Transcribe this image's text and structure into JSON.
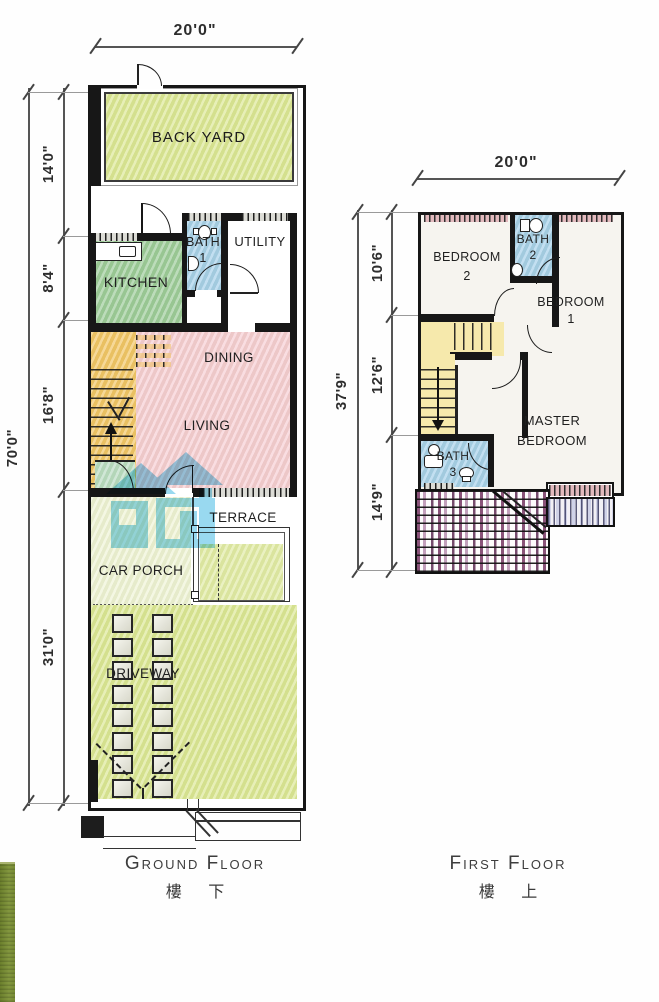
{
  "ground_floor": {
    "title": "Ground Floor",
    "title_cn": "樓 下",
    "dims": {
      "width": "20'0\"",
      "total_depth": "70'0\"",
      "segments": [
        "14'0\"",
        "8'4\"",
        "16'8\"",
        "31'0\""
      ]
    },
    "rooms": {
      "back_yard": "BACK YARD",
      "kitchen": "KITCHEN",
      "bath1": [
        "BATH",
        "1"
      ],
      "utility": "UTILITY",
      "dining": "DINING",
      "living": "LIVING",
      "terrace": "TERRACE",
      "car_porch": "CAR PORCH",
      "driveway": "DRIVEWAY"
    }
  },
  "first_floor": {
    "title": "First Floor",
    "title_cn": "樓 上",
    "dims": {
      "width": "20'0\"",
      "total_depth": "37'9\"",
      "segments": [
        "10'6\"",
        "12'6\"",
        "14'9\""
      ]
    },
    "rooms": {
      "bedroom2": [
        "BEDROOM",
        "2"
      ],
      "bath2": [
        "BATH",
        "2"
      ],
      "bedroom1": [
        "BEDROOM",
        "1"
      ],
      "master_bedroom": [
        "MASTER",
        "BEDROOM"
      ],
      "bath3": [
        "BATH",
        "3"
      ]
    }
  },
  "colors": {
    "yard-green": "#dce795",
    "kitchen-green": "#9ccb99",
    "bath-blue": "#a6d0ea",
    "living-pink": "#f6cdd3",
    "stair-orange": "#f2c566",
    "stair-yellow": "#f6e9ac",
    "porch-pale": "#eff3d6",
    "store-green": "#b9dcc2",
    "watermark-blue": "#7fd0ec",
    "roof-purple": "#8c5a7e",
    "wall-black": "#171717",
    "grass-strip": "#7d9038"
  }
}
